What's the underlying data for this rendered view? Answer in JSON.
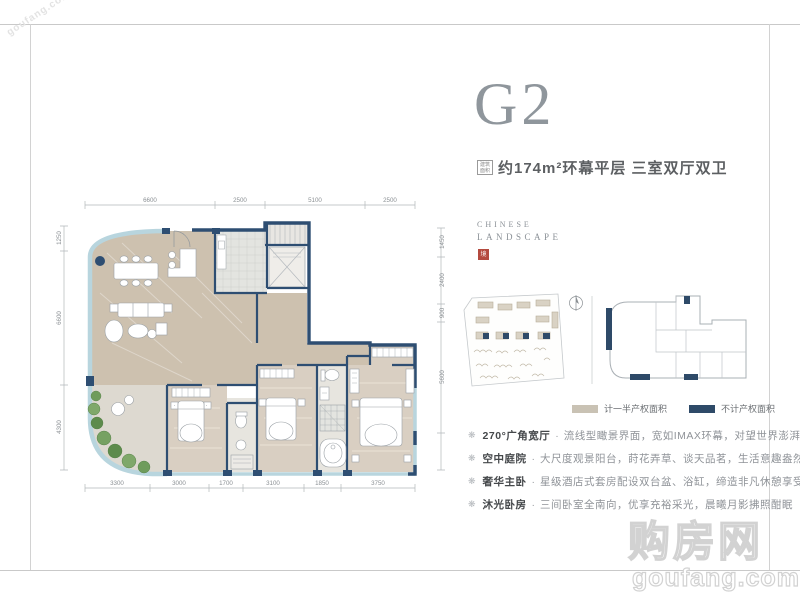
{
  "header": {
    "title": "G2",
    "area_seal": "建筑面积",
    "subtitle": "约174m²环幕平层 三室双厅双卫"
  },
  "brand": {
    "line1": "CHINESE",
    "line2": "LANDSCAPE",
    "seal_char": "境"
  },
  "legend": {
    "half_property": "计一半产权面积",
    "no_property": "不计产权面积"
  },
  "features": [
    {
      "label": "270°广角宽厅",
      "sep": "·",
      "text": "流线型瞰景界面，宽如IMAX环幕，对望世界澎湃"
    },
    {
      "label": "空中庭院",
      "sep": "·",
      "text": "大尺度观景阳台，莳花弄草、谈天品茗，生活意趣盎然"
    },
    {
      "label": "奢华主卧",
      "sep": "·",
      "text": "星级酒店式套房配设双台盆、浴缸，缔造非凡休憩享受"
    },
    {
      "label": "沐光卧房",
      "sep": "·",
      "text": "三间卧室全南向，优享充裕采光，晨曦月影拂照酣眠"
    }
  ],
  "plan": {
    "dims_top": [
      "6600",
      "2500",
      "5100",
      "2500"
    ],
    "dims_left": [
      "1250",
      "6600",
      "4300"
    ],
    "dims_right": [
      "1450",
      "2400",
      "900",
      "5600"
    ],
    "dims_bottom": [
      "3300",
      "3000",
      "1700",
      "3100",
      "1850",
      "3750"
    ]
  },
  "icons": {
    "bullet": "❋",
    "north": "N"
  },
  "watermark": {
    "name": "购房网",
    "site": "goufang.com",
    "corner": "goufang.com"
  },
  "colors": {
    "wall_navy": "#2e4e72",
    "glass_blue": "#b8d5de",
    "floor_tan": "#cdc1af",
    "floor_wood": "#d9cfc2",
    "legend_half": "#c9c2b4",
    "legend_none": "#2e4a68",
    "brand_red": "#b44a3f"
  }
}
